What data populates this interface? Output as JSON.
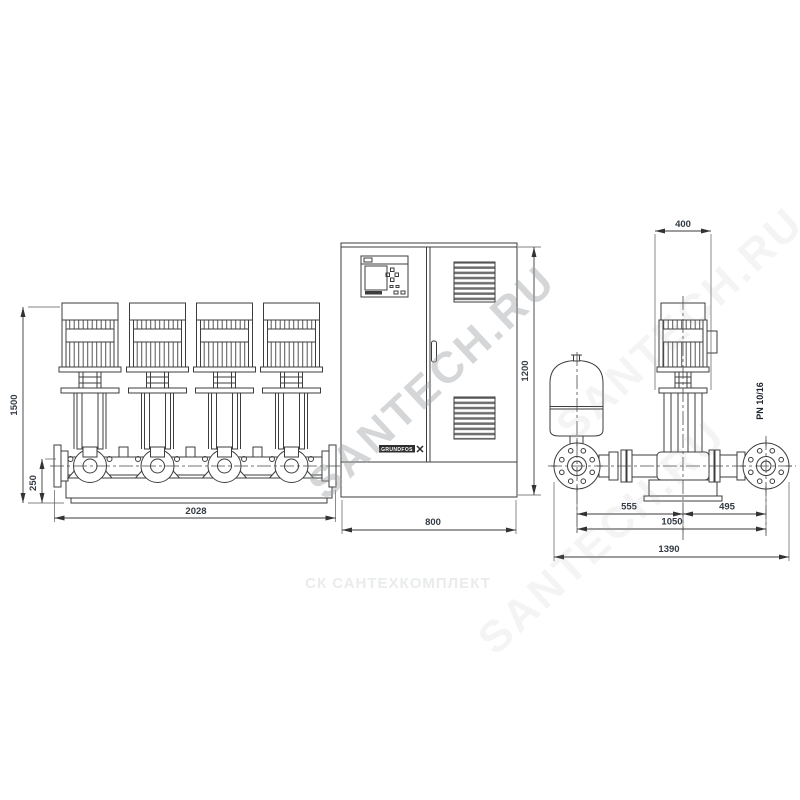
{
  "front_view": {
    "total_height": "1500",
    "base_height": "250",
    "total_length": "2028"
  },
  "cabinet": {
    "width": "800",
    "height": "1200",
    "brand": "GRUNDFOS"
  },
  "side_view": {
    "motor_width": "400",
    "suction_to_center": "555",
    "center_to_discharge": "495",
    "flange_to_flange": "1050",
    "total_depth": "1390",
    "pressure_rating": "PN 10/16"
  },
  "watermarks": {
    "diagonal": "SANTECH.RU",
    "footer": "СК САНТЕХКОМПЛЕКТ"
  },
  "colors": {
    "line": "#3d3d3d",
    "dim_text": "#333b44",
    "watermark": "#9aa0a4",
    "footer_watermark": "#e9ebec",
    "background": "#ffffff"
  }
}
